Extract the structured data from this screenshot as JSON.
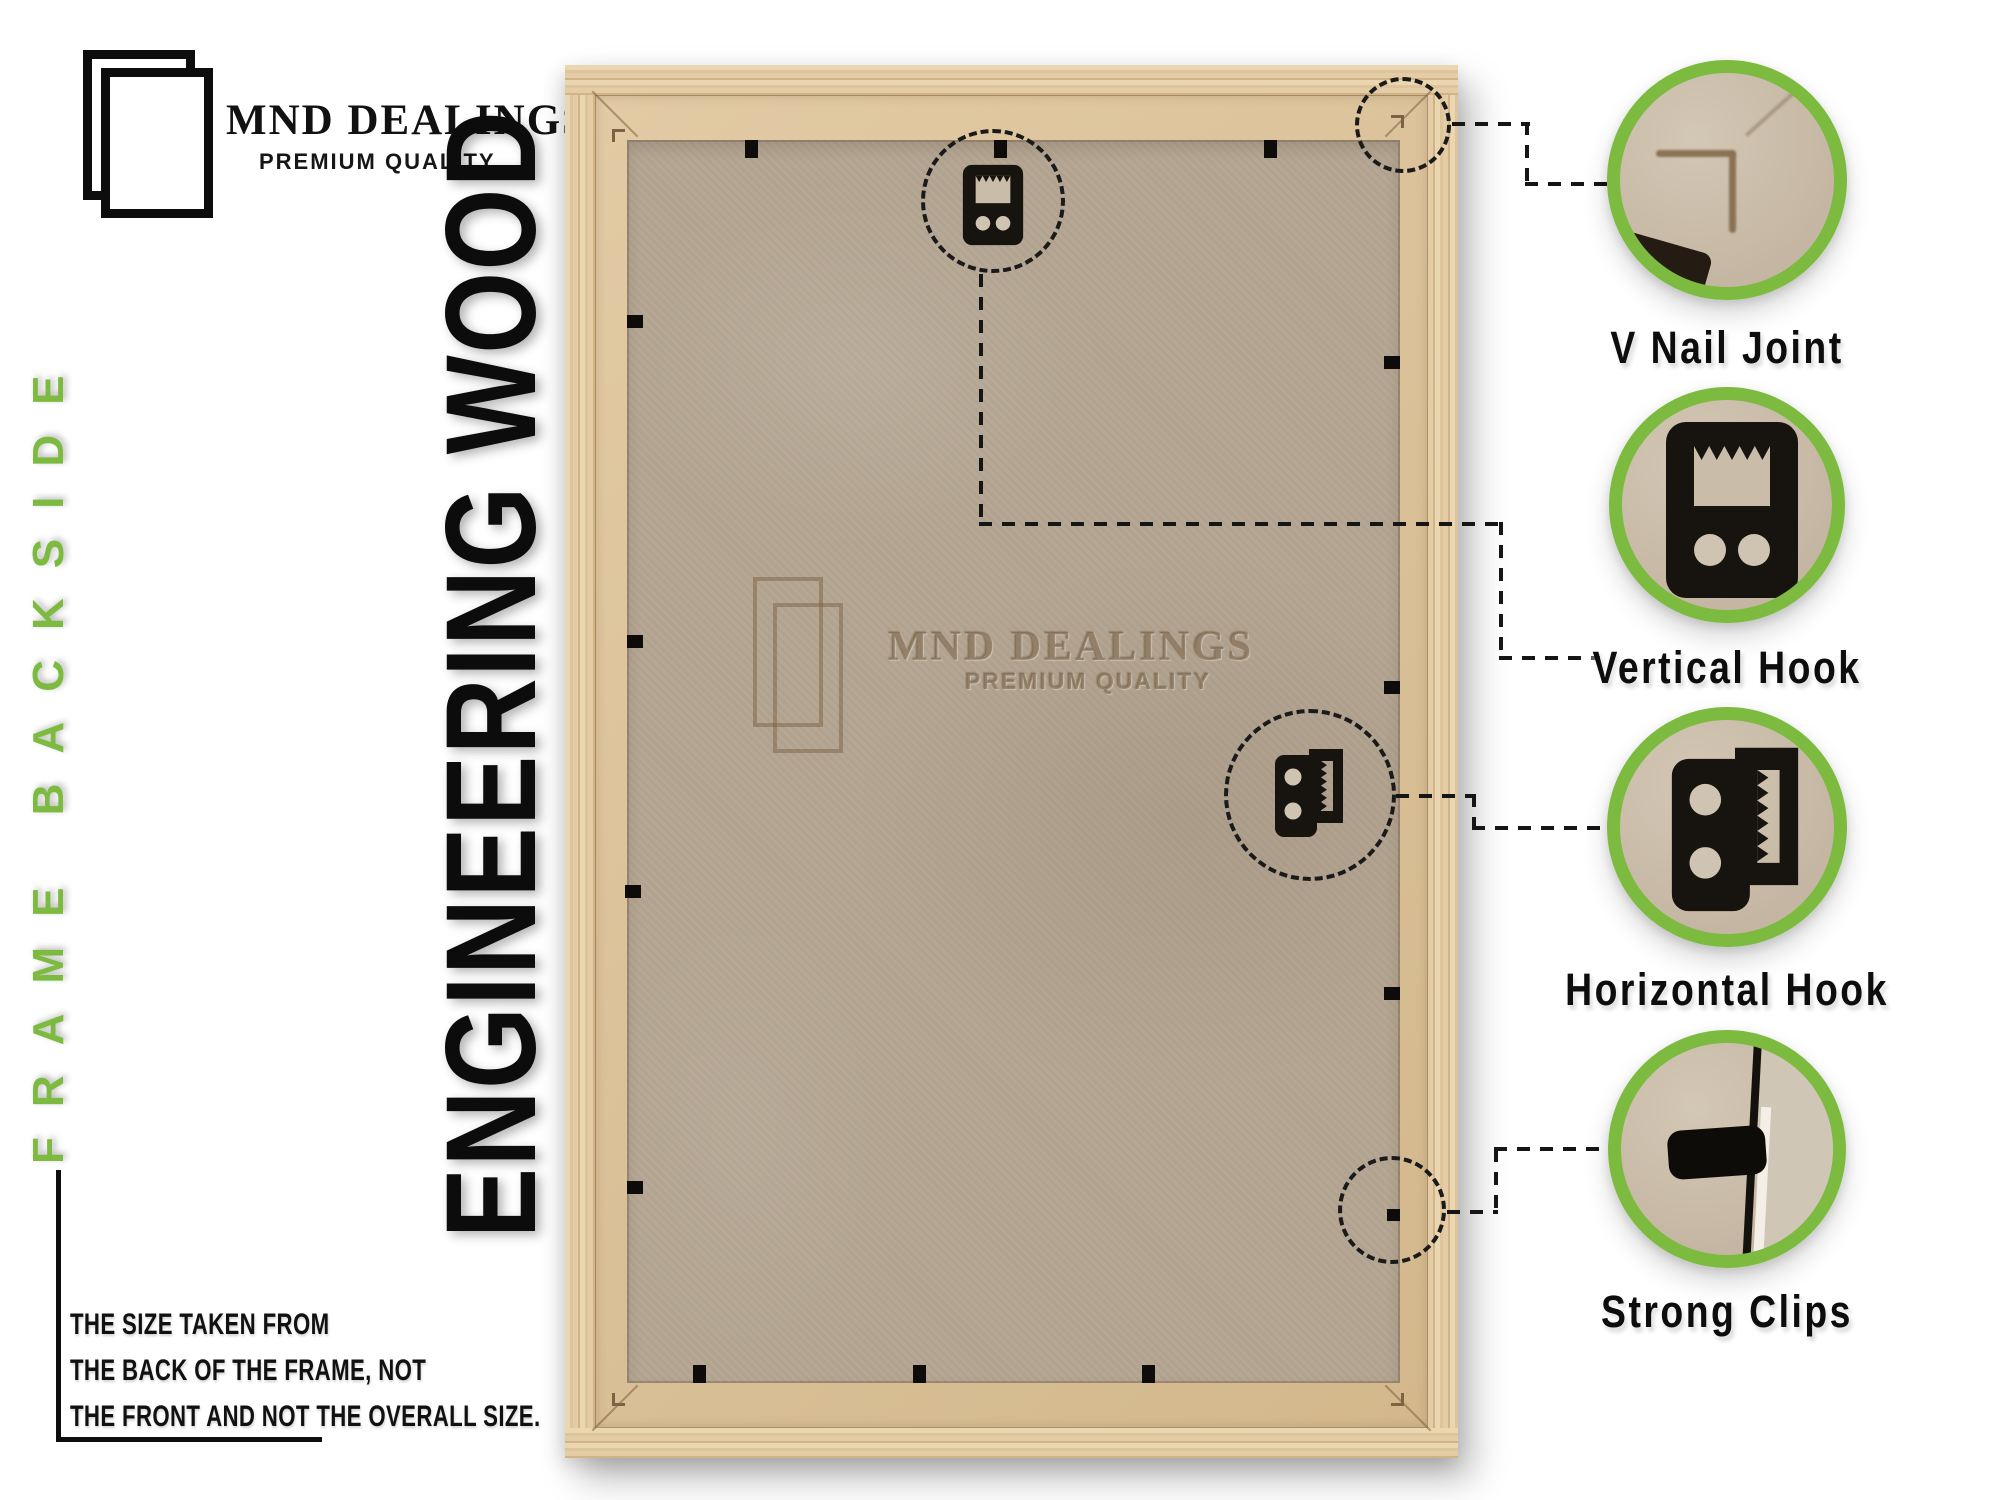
{
  "colors": {
    "accent": "#7cbb3f",
    "ink": "#121212",
    "mdf": "#b3a591",
    "mdf_light": "#c9bca9",
    "lip": "#d8c09a",
    "emboss": "#8d7457",
    "leader": "#151515"
  },
  "logo": {
    "title": "MND DEALINGS",
    "subtitle": "PREMIUM QUALITY"
  },
  "side_label": "FRAME BACKSIDE",
  "material_label": "ENGINEERING WOOD",
  "watermark": {
    "title": "MND DEALINGS",
    "subtitle": "PREMIUM QUALITY"
  },
  "note_lines": [
    "THE SIZE TAKEN FROM",
    "THE BACK OF THE FRAME, NOT",
    "THE FRONT AND NOT THE OVERALL SIZE."
  ],
  "callouts": [
    {
      "label": "V Nail Joint"
    },
    {
      "label": "Vertical Hook"
    },
    {
      "label": "Horizontal Hook"
    },
    {
      "label": "Strong Clips"
    }
  ]
}
